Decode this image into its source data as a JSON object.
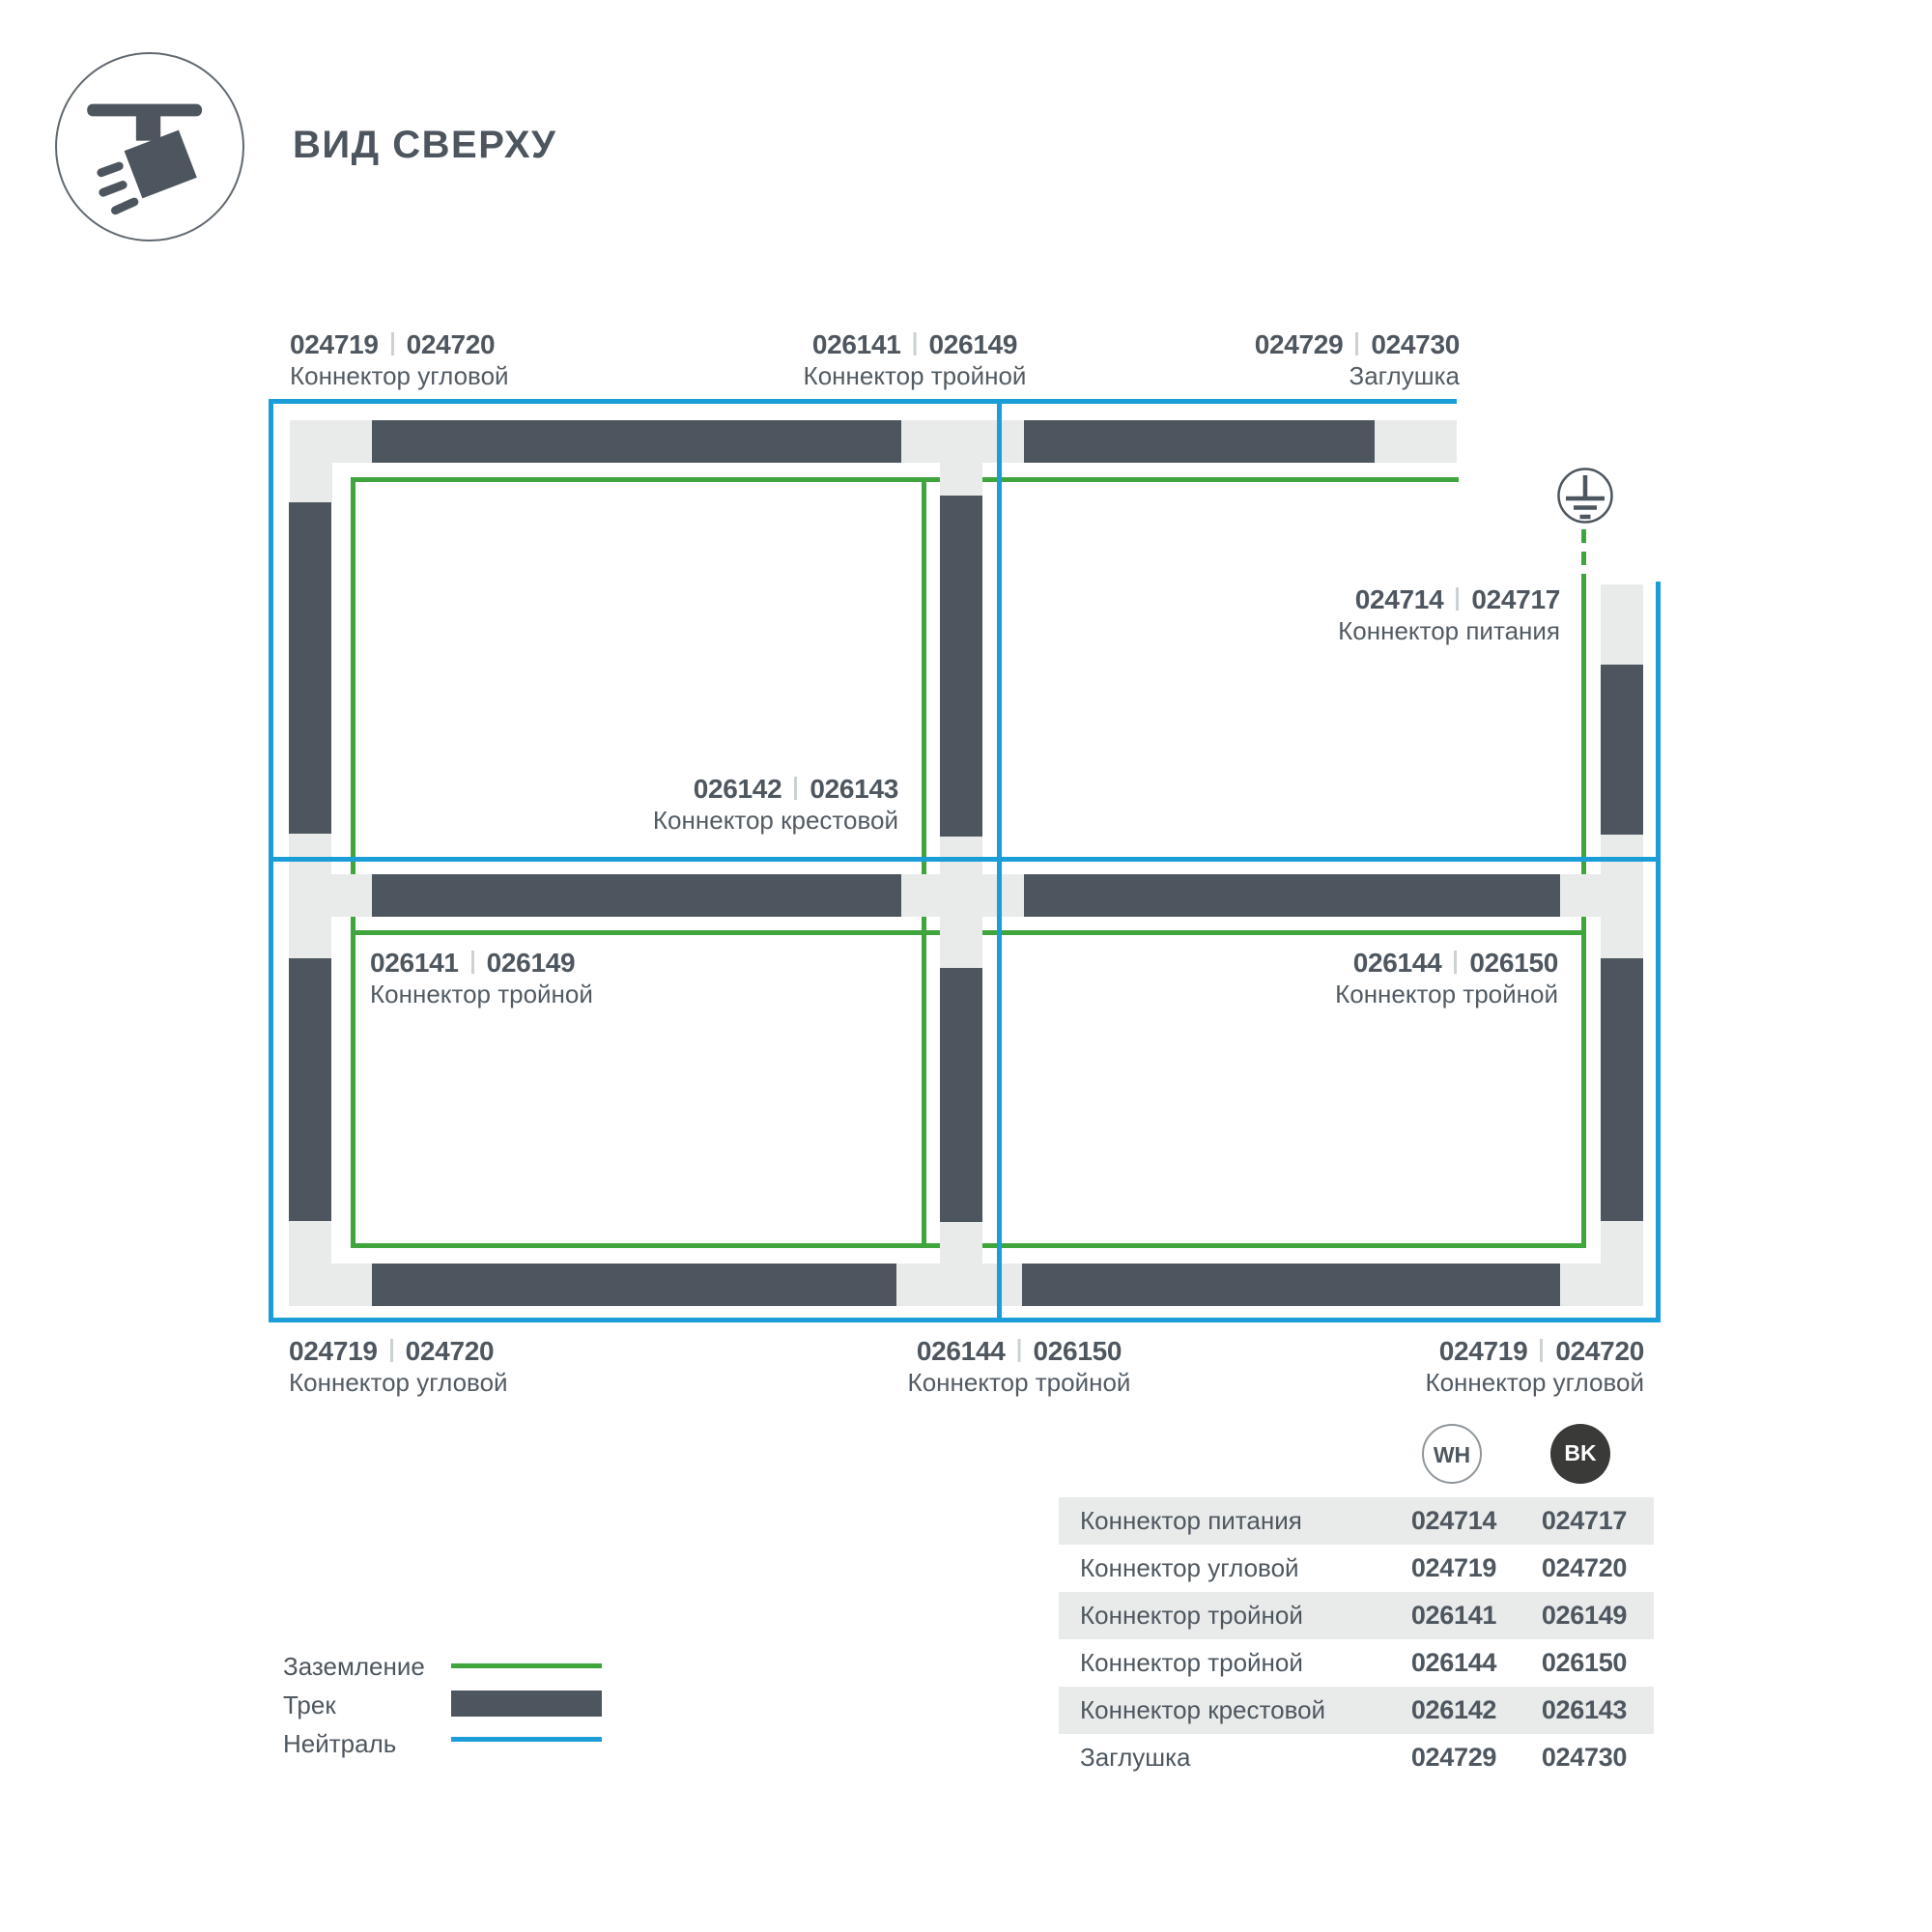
{
  "header": {
    "title": "ВИД СВЕРХУ"
  },
  "labels": {
    "top_left": {
      "wh": "024719",
      "bk": "024720",
      "name": "Коннектор угловой"
    },
    "top_middle": {
      "wh": "026141",
      "bk": "026149",
      "name": "Коннектор тройной"
    },
    "top_right": {
      "wh": "024729",
      "bk": "024730",
      "name": "Заглушка"
    },
    "power": {
      "wh": "024714",
      "bk": "024717",
      "name": "Коннектор питания"
    },
    "cross": {
      "wh": "026142",
      "bk": "026143",
      "name": "Коннектор крестовой"
    },
    "mid_left": {
      "wh": "026141",
      "bk": "026149",
      "name": "Коннектор тройной"
    },
    "mid_right": {
      "wh": "026144",
      "bk": "026150",
      "name": "Коннектор тройной"
    },
    "bottom_left": {
      "wh": "024719",
      "bk": "024720",
      "name": "Коннектор угловой"
    },
    "bottom_middle": {
      "wh": "026144",
      "bk": "026150",
      "name": "Коннектор тройной"
    },
    "bottom_right": {
      "wh": "024719",
      "bk": "024720",
      "name": "Коннектор угловой"
    }
  },
  "legend": {
    "ground": "Заземление",
    "track": "Трек",
    "neutral": "Нейтраль"
  },
  "table": {
    "col_wh": "WH",
    "col_bk": "BK",
    "rows": [
      {
        "name": "Коннектор питания",
        "wh": "024714",
        "bk": "024717"
      },
      {
        "name": "Коннектор угловой",
        "wh": "024719",
        "bk": "024720"
      },
      {
        "name": "Коннектор тройной",
        "wh": "026141",
        "bk": "026149"
      },
      {
        "name": "Коннектор тройной",
        "wh": "026144",
        "bk": "026150"
      },
      {
        "name": "Коннектор крестовой",
        "wh": "026142",
        "bk": "026143"
      },
      {
        "name": "Заглушка",
        "wh": "024729",
        "bk": "024730"
      }
    ]
  },
  "colors": {
    "track": "#4d565e",
    "connector": "#e9ebeb",
    "ground": "#3fa53c",
    "neutral": "#1b9dd8",
    "text": "#4e575f",
    "table_band": "#e9ebeb",
    "bk_badge": "#3a3a38"
  }
}
